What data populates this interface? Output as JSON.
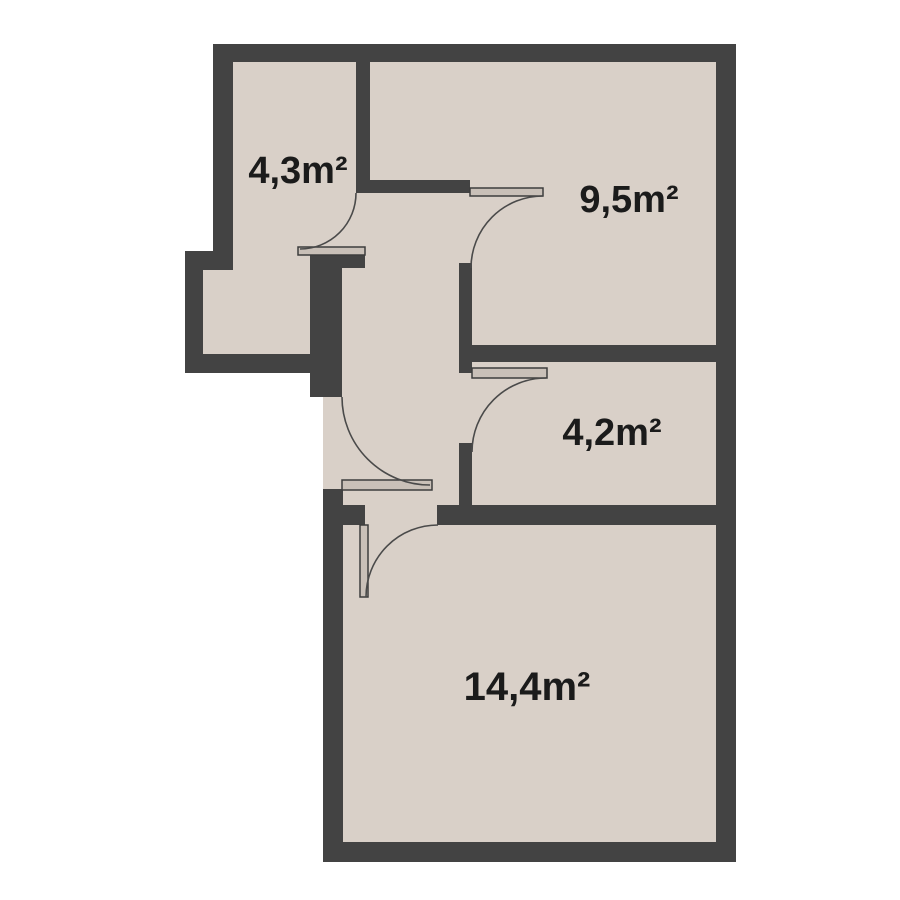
{
  "plan": {
    "type": "apartment-floor-plan",
    "rooms": [
      {
        "id": "room-top-left",
        "area_label": "4,3m²"
      },
      {
        "id": "room-top-right",
        "area_label": "9,5m²"
      },
      {
        "id": "room-middle-right",
        "area_label": "4,2m²"
      },
      {
        "id": "room-bottom",
        "area_label": "14,4m²"
      }
    ],
    "colors": {
      "background": "#ffffff",
      "floor": "#d9d0c8",
      "wall": "#434343",
      "door_leaf": "#c9c0b8",
      "door_outline": "#3d3d3d",
      "swing_arc": "#4a4a4a",
      "label_text": "#1b1b1b"
    }
  }
}
